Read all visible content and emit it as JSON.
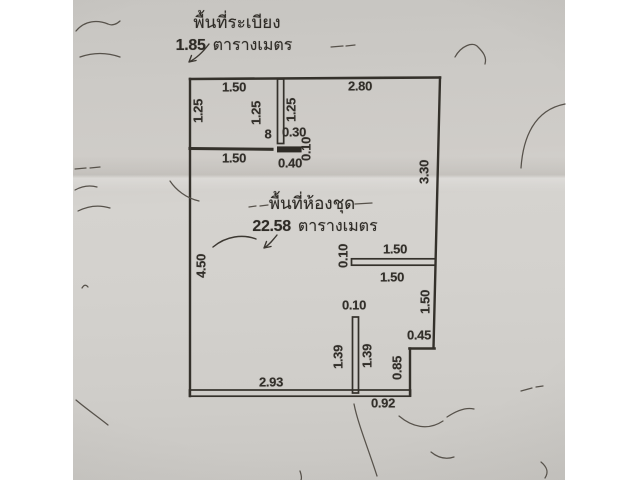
{
  "document": {
    "type": "scanned-floor-plan",
    "paper_color": "#d0cecb",
    "ink_color": "#33302b"
  },
  "balcony_label": {
    "title": "พื้นที่ระเบียง",
    "area_value": "1.85",
    "area_unit": "ตารางเมตร"
  },
  "unit_label": {
    "title": "พื้นที่ห้องชุด",
    "area_value": "22.58",
    "area_unit": "ตารางเมตร"
  },
  "dims": {
    "balcony_top_width": "1.50",
    "top_right_width": "2.80",
    "balcony_left_height": "1.25",
    "balcony_inner_height": "1.25",
    "divider_right_height": "1.25",
    "wall_gap": "8",
    "notch_top_width": "0.30",
    "notch_thickness": "0.10",
    "notch_bottom_width": "0.40",
    "balcony_bottom_width": "1.50",
    "right_upper_height": "3.30",
    "left_height": "4.50",
    "mid_wall_top_width": "1.50",
    "mid_wall_bottom_width": "1.50",
    "mid_wall_thickness": "0.10",
    "right_mid_height": "1.50",
    "stub_top_thickness": "0.10",
    "stub_left_height": "1.39",
    "stub_right_height": "1.39",
    "step_width": "0.45",
    "step_height": "0.85",
    "bottom_left_width": "2.93",
    "bottom_right_width": "0.92"
  }
}
